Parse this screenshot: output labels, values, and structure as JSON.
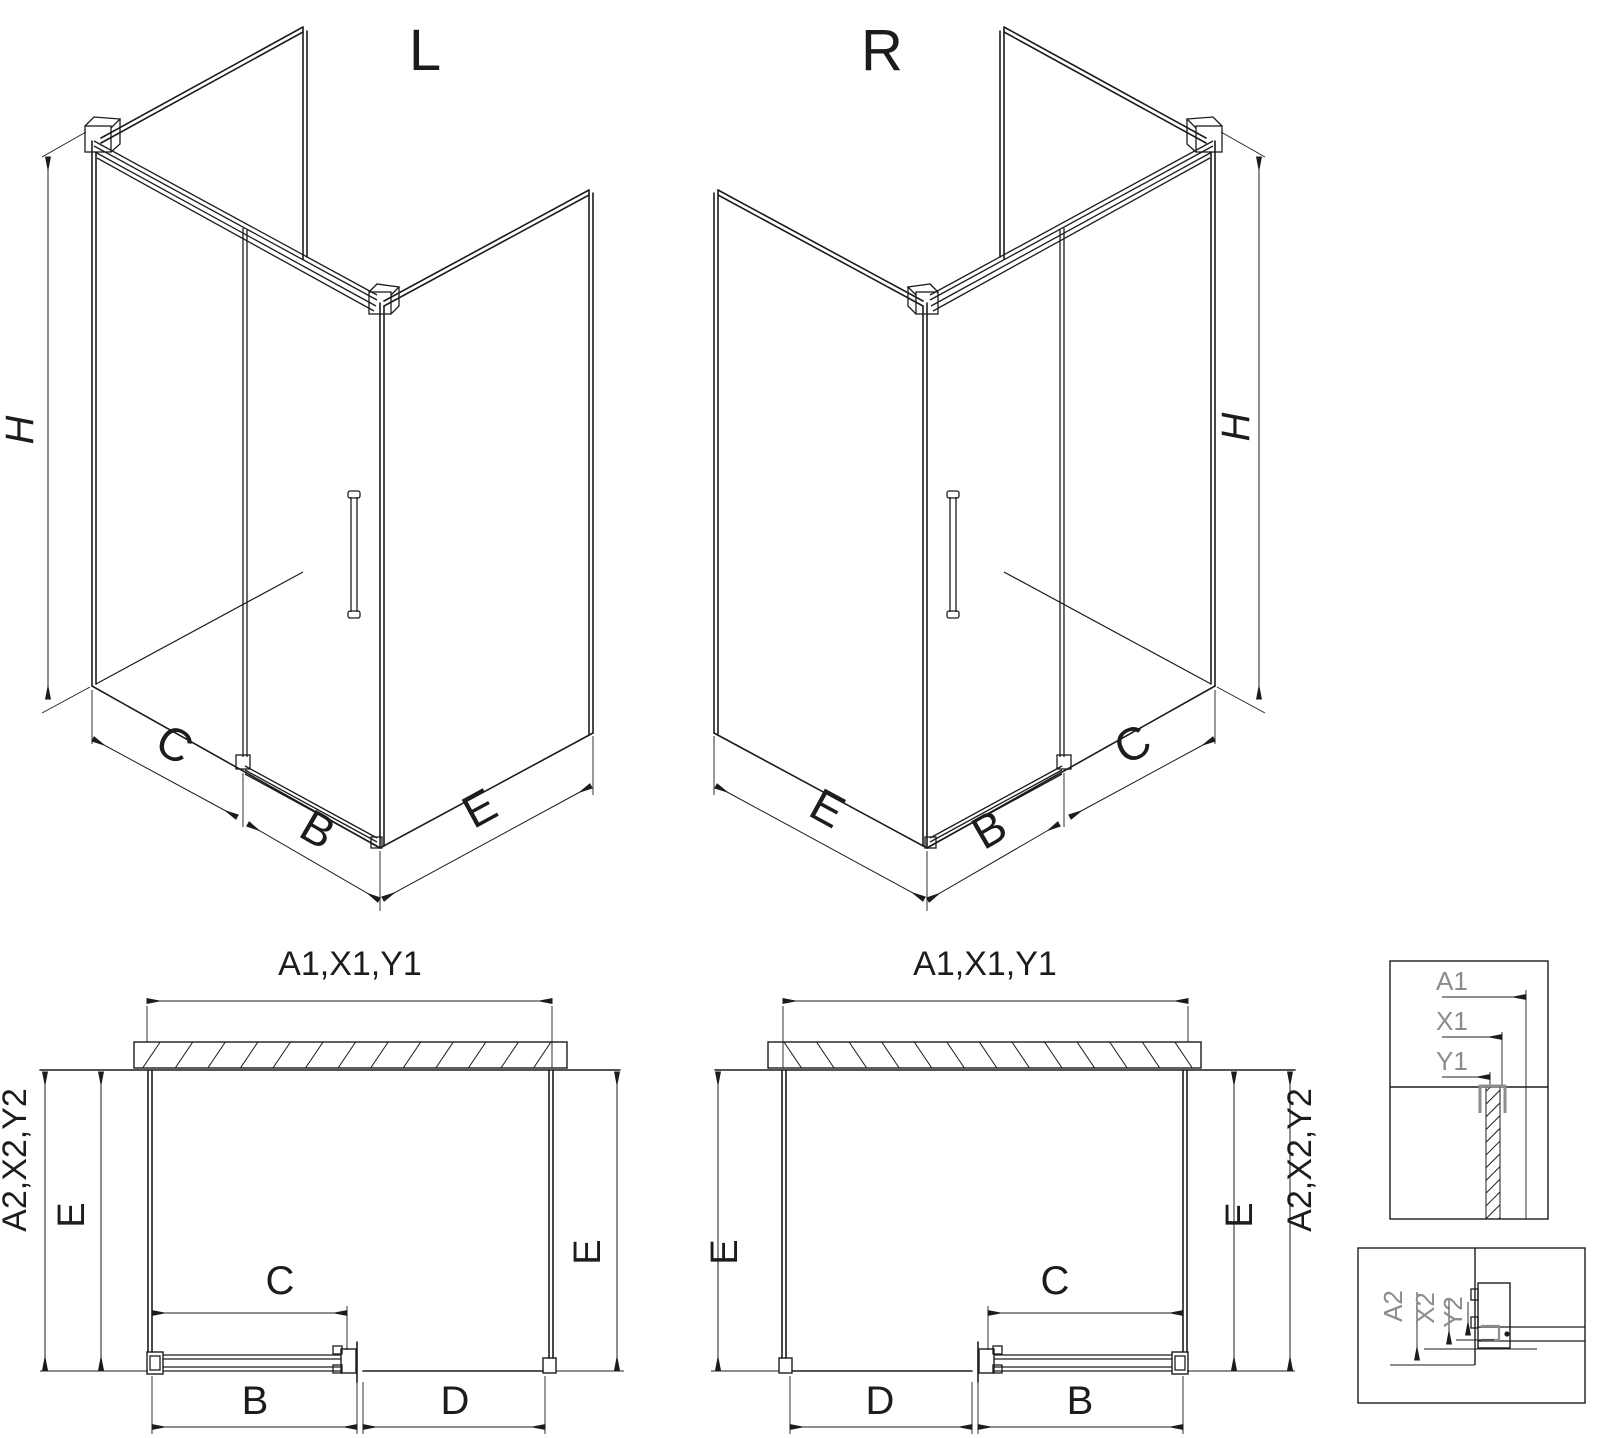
{
  "drawing": {
    "kind": "shower-enclosure-technical-drawing",
    "variants": [
      "L",
      "R"
    ]
  },
  "views": {
    "iso_l": {
      "title": "L",
      "h": "H",
      "c": "C",
      "b": "B",
      "e": "E"
    },
    "iso_r": {
      "title": "R",
      "h": "H",
      "c": "C",
      "b": "B",
      "e": "E"
    },
    "plan_l": {
      "top": "A1,X1,Y1",
      "side_outer": "A2,X2,Y2",
      "side_inner_e": "E",
      "side_right_e": "E",
      "c": "C",
      "b": "B",
      "d": "D"
    },
    "plan_r": {
      "top": "A1,X1,Y1",
      "side_outer": "A2,X2,Y2",
      "side_inner_e": "E",
      "side_right_e": "E",
      "c": "C",
      "b": "B",
      "d": "D"
    },
    "detail_top": {
      "a1": "A1",
      "x1": "X1",
      "y1": "Y1"
    },
    "detail_bottom": {
      "a2": "A2",
      "x2": "X2",
      "y2": "Y2"
    }
  },
  "colors": {
    "line": "#1c1c1c",
    "gray": "#8c8c8c",
    "background": "#ffffff"
  }
}
